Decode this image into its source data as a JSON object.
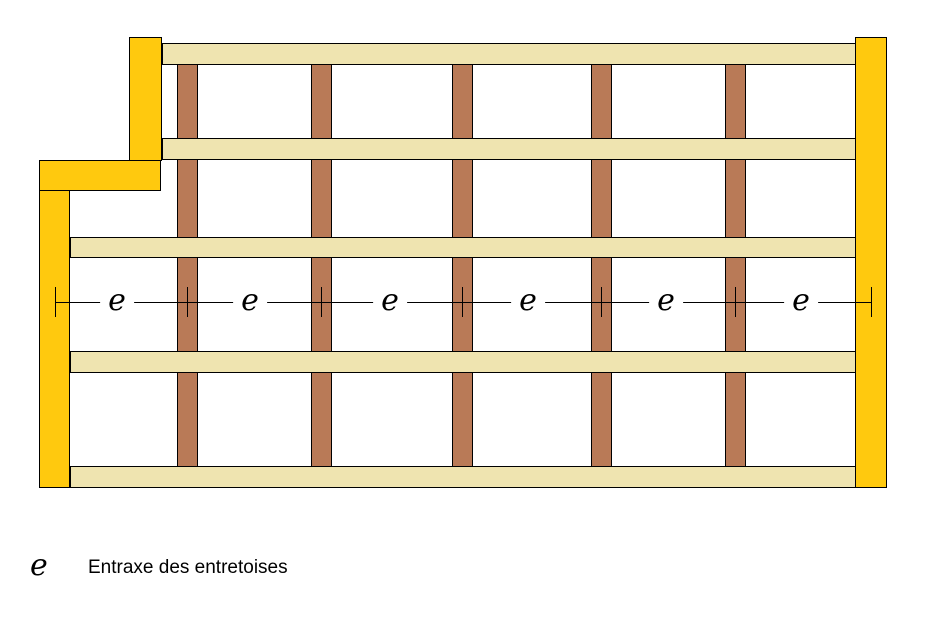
{
  "canvas": {
    "width": 936,
    "height": 634,
    "background": "#FFFFFF"
  },
  "colors": {
    "post": "#FFC90E",
    "beam": "#EFE4B0",
    "brace": "#B97A57",
    "outline": "#000000",
    "line": "#000000"
  },
  "diagram": {
    "posts": [
      {
        "name": "left-post-top",
        "x": 129,
        "y": 37,
        "w": 33,
        "h": 124
      },
      {
        "name": "left-post-ledge",
        "x": 39,
        "y": 160,
        "w": 122,
        "h": 31
      },
      {
        "name": "left-post-lower",
        "x": 39,
        "y": 190,
        "w": 31,
        "h": 298
      },
      {
        "name": "right-post",
        "x": 855,
        "y": 37,
        "w": 32,
        "h": 451
      }
    ],
    "beams": [
      {
        "name": "beam-1",
        "x": 162,
        "y": 43,
        "w": 694,
        "h": 22
      },
      {
        "name": "beam-2",
        "x": 162,
        "y": 138,
        "w": 694,
        "h": 22
      },
      {
        "name": "beam-3",
        "x": 70,
        "y": 237,
        "w": 786,
        "h": 21
      },
      {
        "name": "beam-4",
        "x": 70,
        "y": 351,
        "w": 786,
        "h": 22
      },
      {
        "name": "beam-5",
        "x": 70,
        "y": 466,
        "w": 786,
        "h": 22
      }
    ],
    "braces": {
      "columns_x": [
        177,
        311,
        452,
        591,
        725
      ],
      "width": 21,
      "rows": [
        {
          "y": 64,
          "h": 75
        },
        {
          "y": 159,
          "h": 79
        },
        {
          "y": 257,
          "h": 95
        },
        {
          "y": 372,
          "h": 95
        }
      ]
    },
    "dimension_line": {
      "label": "e",
      "y": 302,
      "x_start": 55,
      "x_end": 871,
      "tick_xs": [
        55,
        187,
        321,
        462,
        601,
        735,
        871
      ],
      "tick_height": 30,
      "label_xs": [
        117,
        250,
        390,
        528,
        666,
        801
      ]
    }
  },
  "legend": {
    "symbol": "e",
    "label": "Entraxe des entretoises"
  }
}
